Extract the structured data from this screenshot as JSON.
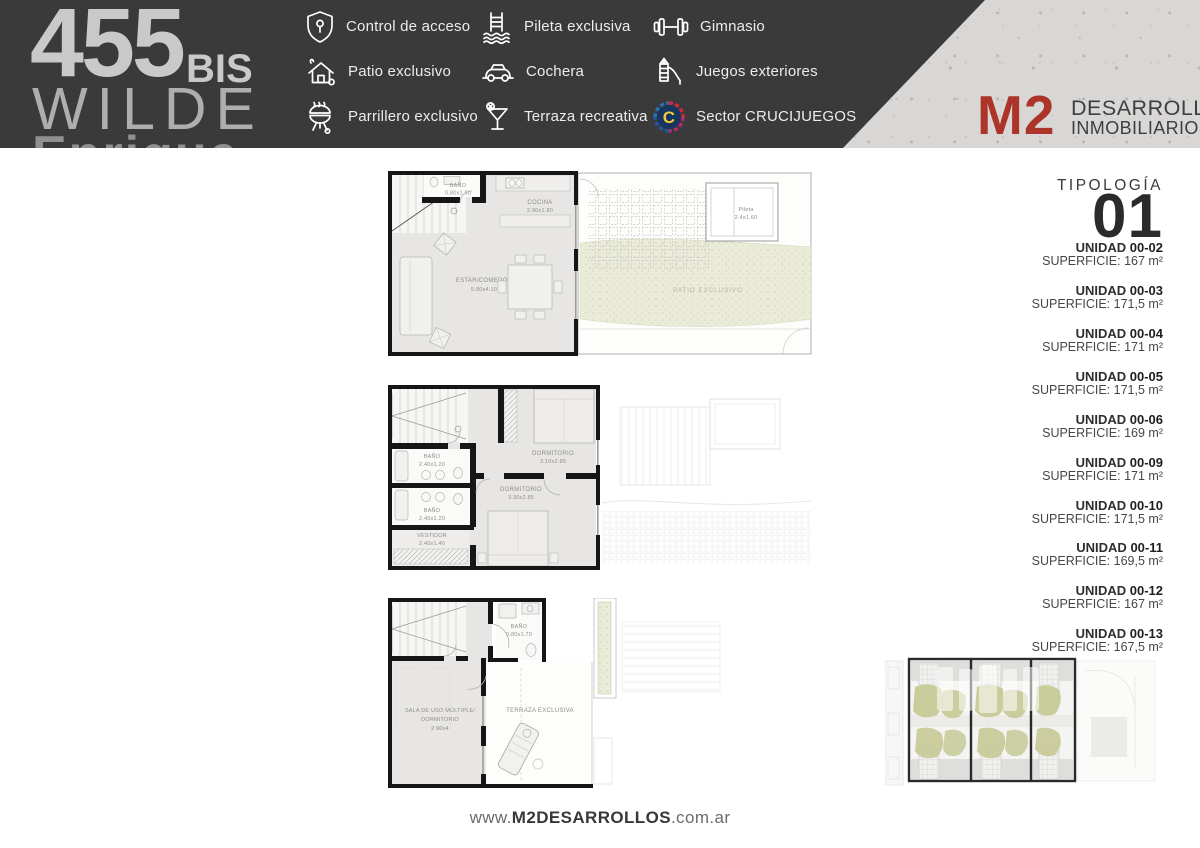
{
  "header": {
    "logo": {
      "number": "455",
      "suffix": "BIS",
      "city": "WILDE",
      "line3_cutoff": "Enrique"
    },
    "amenities": [
      {
        "icon": "shield-access-icon",
        "label": "Control de acceso"
      },
      {
        "icon": "pool-ladder-icon",
        "label": "Pileta exclusiva"
      },
      {
        "icon": "dumbbell-icon",
        "label": "Gimnasio"
      },
      {
        "icon": "patio-house-icon",
        "label": "Patio exclusivo"
      },
      {
        "icon": "car-icon",
        "label": "Cochera"
      },
      {
        "icon": "playground-slide-icon",
        "label": "Juegos exteriores"
      },
      {
        "icon": "bbq-grill-icon",
        "label": "Parrillero exclusivo"
      },
      {
        "icon": "cocktail-icon",
        "label": "Terraza recreativa"
      },
      {
        "icon": "crucijuegos-logo-icon",
        "label": "Sector CRUCIJUEGOS"
      }
    ],
    "brand": {
      "logo": "M2",
      "line1": "DESARROLLOS",
      "line2": "INMOBILIARIOS."
    },
    "colors": {
      "header_bg": "#3a3a3a",
      "brand_red": "#ac3429",
      "concrete": "#d8d7d5"
    }
  },
  "plans": {
    "ground": {
      "bano_name": "BAÑO",
      "bano_dims": "0.80x1.90",
      "cocina_name": "COCINA",
      "cocina_dims": "2.90x1.80",
      "estar_name": "ESTAR/COMEDOR",
      "estar_dims": "5.80x4.10",
      "pileta_name": "Pileta",
      "pileta_dims": "2.4x1.60",
      "patio_name": "PATIO EXCLUSIVO"
    },
    "upper": {
      "dorm1_name": "DORMITORIO",
      "dorm1_dims": "3.10x2.85",
      "dorm2_name": "DORMITORIO",
      "dorm2_dims": "3.30x2.85",
      "bano1_name": "BAÑO",
      "bano1_dims": "2.40x1.20",
      "bano2_name": "BAÑO",
      "bano2_dims": "2.40x1.20",
      "vestidor_name": "VESTIDOR",
      "vestidor_dims": "2.40x1.40"
    },
    "roof": {
      "bano_name": "BAÑO",
      "bano_dims": "0.80x1.70",
      "sala_line1": "SALA DE USO MÚLTIPLE/",
      "sala_line2": "DORMITORIO",
      "sala_dims": "2.90x4",
      "terraza_name": "TERRAZA EXCLUSIVA"
    }
  },
  "sidebar": {
    "tipologia_label": "TIPOLOGÍA",
    "tipologia_number": "01",
    "unidad_label": "UNIDAD",
    "superficie_label": "SUPERFICIE:",
    "units": [
      {
        "code": "00-02",
        "area": "167 m²"
      },
      {
        "code": "00-03",
        "area": "171,5 m²"
      },
      {
        "code": "00-04",
        "area": "171 m²"
      },
      {
        "code": "00-05",
        "area": "171,5 m²"
      },
      {
        "code": "00-06",
        "area": "169 m²"
      },
      {
        "code": "00-09",
        "area": "171 m²"
      },
      {
        "code": "00-10",
        "area": "171,5 m²"
      },
      {
        "code": "00-11",
        "area": "169,5 m²"
      },
      {
        "code": "00-12",
        "area": "167 m²"
      },
      {
        "code": "00-13",
        "area": "167,5 m²"
      }
    ]
  },
  "footer": {
    "www": "www.",
    "domain": "M2DESARROLLOS",
    "tld": ".com.ar"
  }
}
